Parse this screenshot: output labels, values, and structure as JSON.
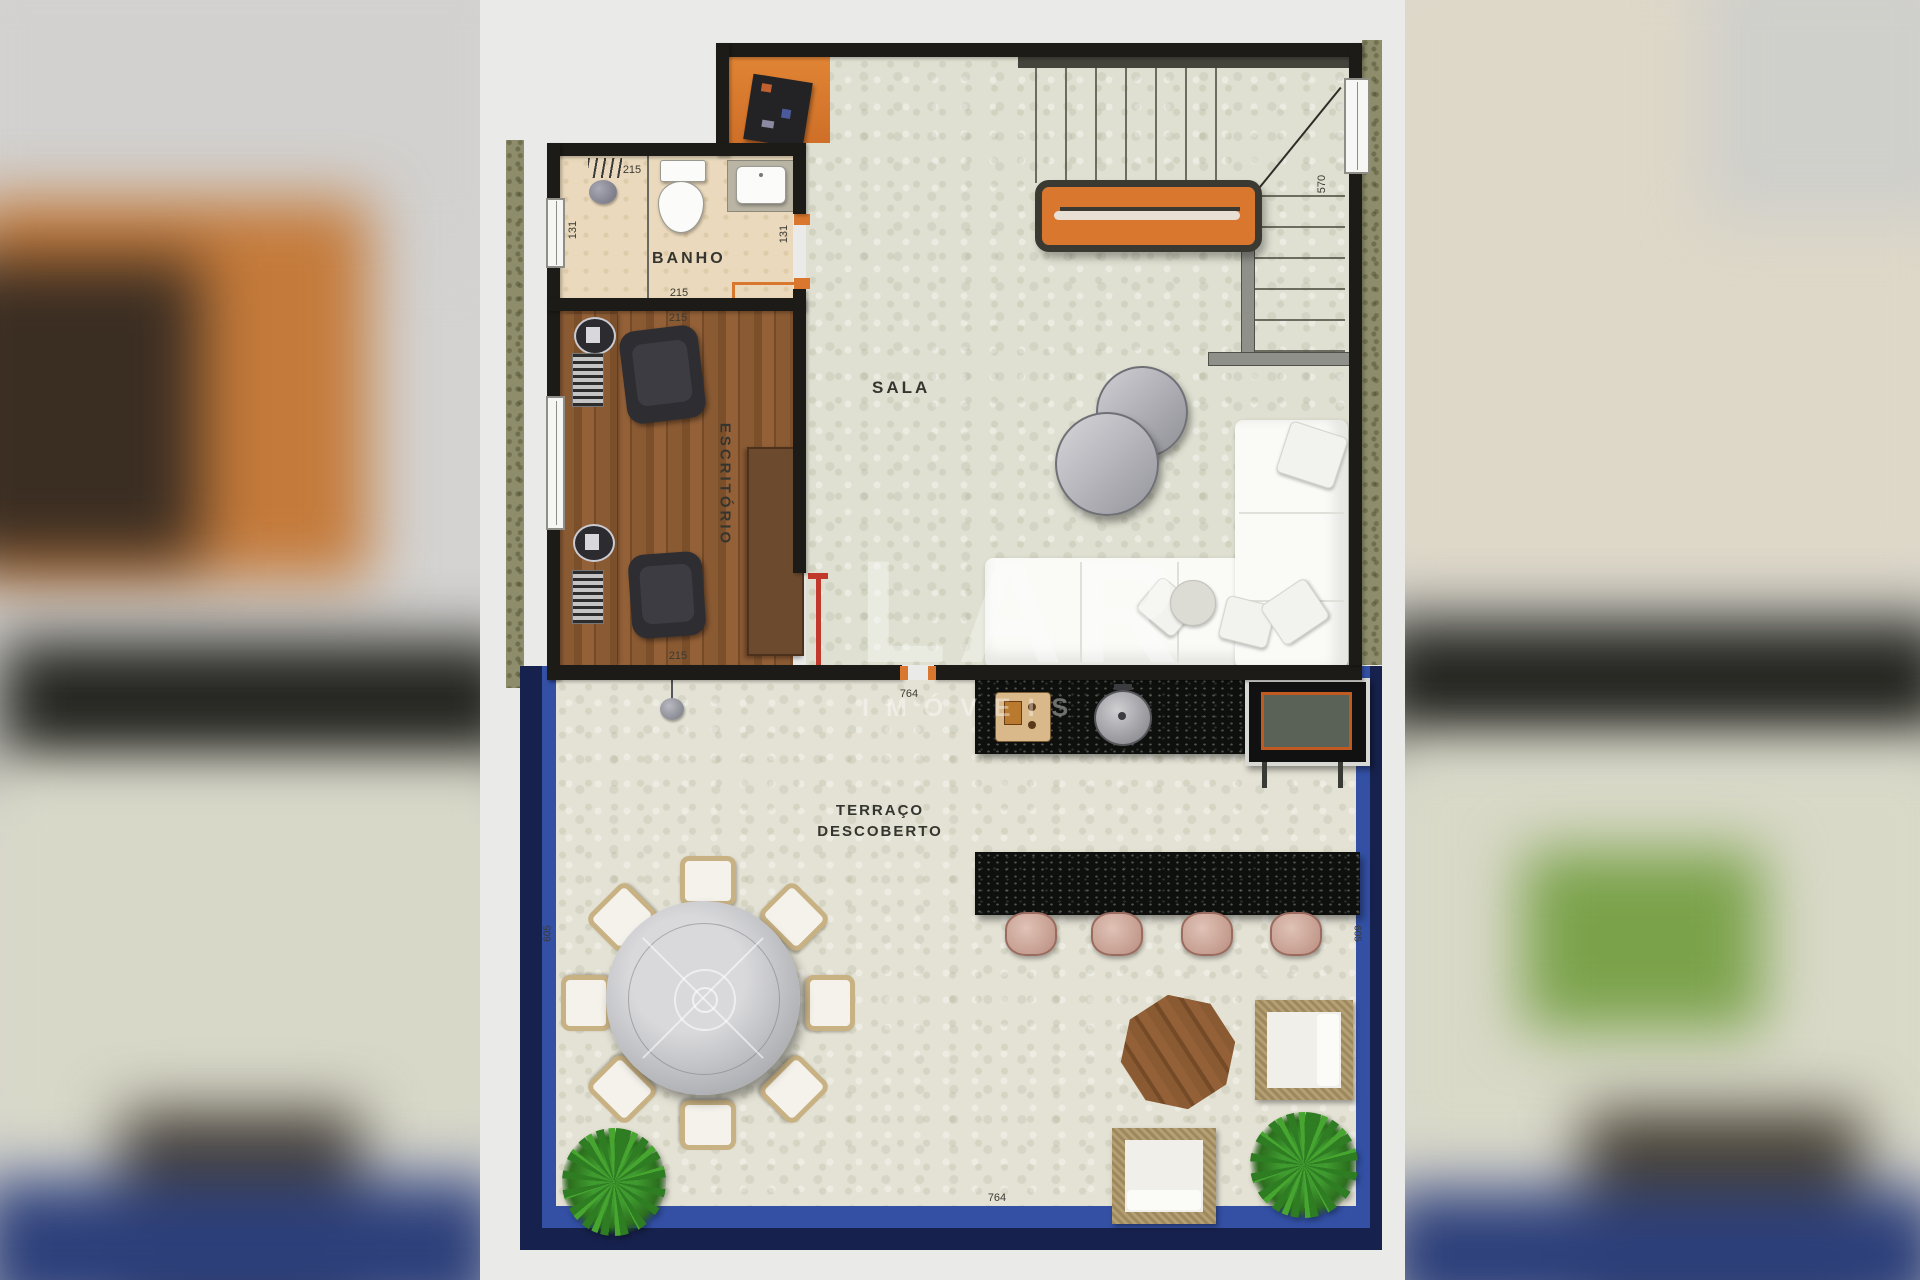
{
  "watermark": {
    "title": "LAR",
    "subtitle": "IMÓVEIS"
  },
  "rooms": {
    "banho": {
      "label": "BANHO",
      "dims": {
        "top": "215",
        "bottom": "215",
        "left": "131",
        "right": "131"
      }
    },
    "escritorio": {
      "label": "ESCRITÓRIO",
      "dims": {
        "top": "215",
        "bottom": "215"
      }
    },
    "sala": {
      "label": "SALA"
    },
    "terraco": {
      "label_line1": "TERRAÇO",
      "label_line2": "DESCOBERTO",
      "dims": {
        "top": "764",
        "bottom": "764",
        "left": "605",
        "right": "605"
      }
    },
    "stairs": {
      "dims": {
        "flight": "570"
      }
    }
  },
  "colors": {
    "accent_orange": "#d9772f",
    "wall_black": "#1c1b17",
    "terrace_border_blue": "#3350a5",
    "terrace_border_navy": "#17214d",
    "granite_black": "#0e100e",
    "wood_floor": "#8a5a33",
    "bath_floor": "#ead9bc",
    "sala_floor": "#dfe0d1",
    "exterior_green": "#8d8d6b"
  }
}
